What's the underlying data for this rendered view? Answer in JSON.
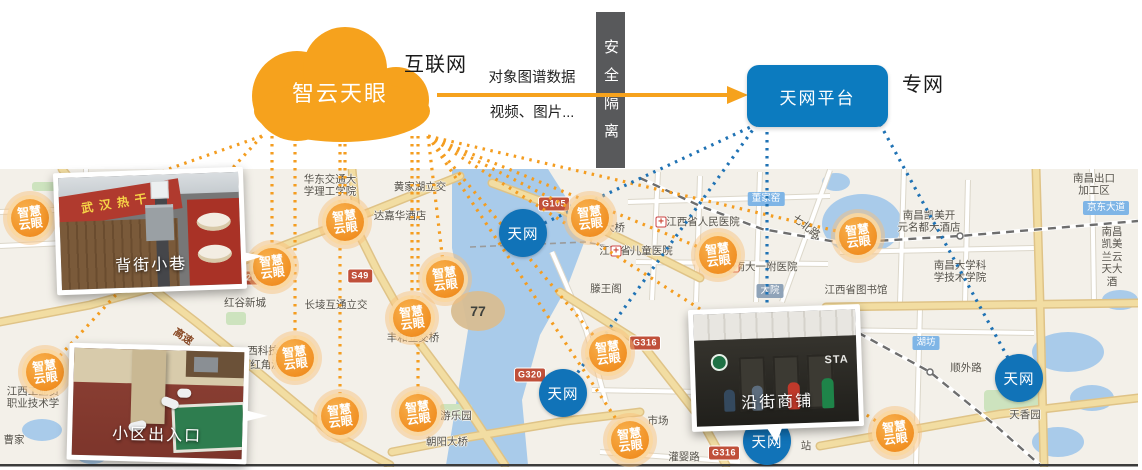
{
  "header": {
    "cloud_label": "智云天眼",
    "internet_label": "互联网",
    "arrow_top_label": "对象图谱数据",
    "arrow_bottom_label": "视频、图片...",
    "barrier_label": "安全隔离",
    "platform_label": "天网平台",
    "private_net_label": "专网"
  },
  "colors": {
    "cloud_orange": "#f6a21d",
    "platform_blue": "#0c7bbf",
    "badge_orange": "#ee8312",
    "badge_blue": "#1173b8",
    "barrier_gray": "#58595b",
    "map_bg": "#f3f0e9",
    "water": "#a9cbea",
    "road_yellow": "#f2dda2",
    "shield_red": "#c0503a"
  },
  "badges": {
    "camera_label": "智慧\n云眼",
    "skynet_label": "天网",
    "camera_positions": [
      [
        30,
        218
      ],
      [
        345,
        222
      ],
      [
        272,
        267
      ],
      [
        445,
        279
      ],
      [
        412,
        318
      ],
      [
        295,
        358
      ],
      [
        45,
        372
      ],
      [
        340,
        416
      ],
      [
        418,
        413
      ],
      [
        590,
        218
      ],
      [
        718,
        255
      ],
      [
        858,
        236
      ],
      [
        608,
        353
      ],
      [
        630,
        440
      ],
      [
        895,
        433
      ]
    ],
    "skynet_positions": [
      [
        523,
        233
      ],
      [
        563,
        393
      ],
      [
        767,
        441
      ],
      [
        1019,
        378
      ]
    ]
  },
  "photos": [
    {
      "caption": "背街小巷",
      "sign_text": "武汉热干"
    },
    {
      "caption": "小区出入口"
    },
    {
      "caption": "沿街商铺",
      "sign_text": "STA"
    }
  ],
  "map": {
    "shields": [
      {
        "text": "G320",
        "x": 245,
        "y": 278
      },
      {
        "text": "G320",
        "x": 530,
        "y": 375
      },
      {
        "text": "G105",
        "x": 554,
        "y": 204
      },
      {
        "text": "S49",
        "x": 360,
        "y": 276
      },
      {
        "text": "G316",
        "x": 645,
        "y": 343
      },
      {
        "text": "G316",
        "x": 724,
        "y": 453
      }
    ],
    "tags": [
      {
        "text": "京东大道",
        "x": 1106,
        "y": 208
      },
      {
        "text": "湖坊",
        "x": 926,
        "y": 343
      },
      {
        "text": "董家窑",
        "x": 766,
        "y": 199
      },
      {
        "text": "大院",
        "x": 770,
        "y": 291,
        "slate": true
      }
    ],
    "labels": [
      {
        "t": "华东交通大\n学理工学院",
        "x": 330,
        "y": 186
      },
      {
        "t": "黄家湖立交",
        "x": 420,
        "y": 187
      },
      {
        "t": "达嘉华酒店",
        "x": 400,
        "y": 216
      },
      {
        "t": "红谷新城",
        "x": 245,
        "y": 303
      },
      {
        "t": "长堎互通立交",
        "x": 336,
        "y": 305
      },
      {
        "t": "丰和立交桥",
        "x": 413,
        "y": 338
      },
      {
        "t": "西科技",
        "x": 263,
        "y": 351
      },
      {
        "t": "红角洲",
        "x": 266,
        "y": 365
      },
      {
        "t": "江西工业贸\n职业技术学",
        "x": 33,
        "y": 398
      },
      {
        "t": "滕王阁",
        "x": 606,
        "y": 289
      },
      {
        "t": "江西省儿童医院",
        "x": 636,
        "y": 251
      },
      {
        "t": "江西省人民医院",
        "x": 703,
        "y": 222
      },
      {
        "t": "南大一附医院",
        "x": 766,
        "y": 267
      },
      {
        "t": "八一大桥",
        "x": 604,
        "y": 228
      },
      {
        "t": "江西省图书馆",
        "x": 856,
        "y": 290
      },
      {
        "t": "七北路",
        "x": 806,
        "y": 227,
        "r": 38
      },
      {
        "t": "南昌出口加工区",
        "x": 1094,
        "y": 185
      },
      {
        "t": "南昌凯美开\n元名都大酒店",
        "x": 929,
        "y": 222
      },
      {
        "t": "南昌凯美\n兰云天大酒",
        "x": 1112,
        "y": 257
      },
      {
        "t": "南昌大学科\n学技术学院",
        "x": 960,
        "y": 272
      },
      {
        "t": "顺外路",
        "x": 966,
        "y": 368
      },
      {
        "t": "天香园",
        "x": 1025,
        "y": 415
      },
      {
        "t": "游乐园",
        "x": 456,
        "y": 416
      },
      {
        "t": "朝阳大桥",
        "x": 447,
        "y": 442
      },
      {
        "t": "市场",
        "x": 658,
        "y": 421
      },
      {
        "t": "灌婴路",
        "x": 684,
        "y": 457
      },
      {
        "t": "站",
        "x": 806,
        "y": 446
      },
      {
        "t": "曹家",
        "x": 14,
        "y": 440
      },
      {
        "t": "高速",
        "x": 183,
        "y": 337,
        "r": 34,
        "road": true
      }
    ],
    "hospital_icons": [
      [
        661,
        222
      ],
      [
        734,
        267
      ],
      [
        616,
        251
      ]
    ],
    "roundabout_label": {
      "text": "77",
      "x": 478,
      "y": 311
    }
  }
}
